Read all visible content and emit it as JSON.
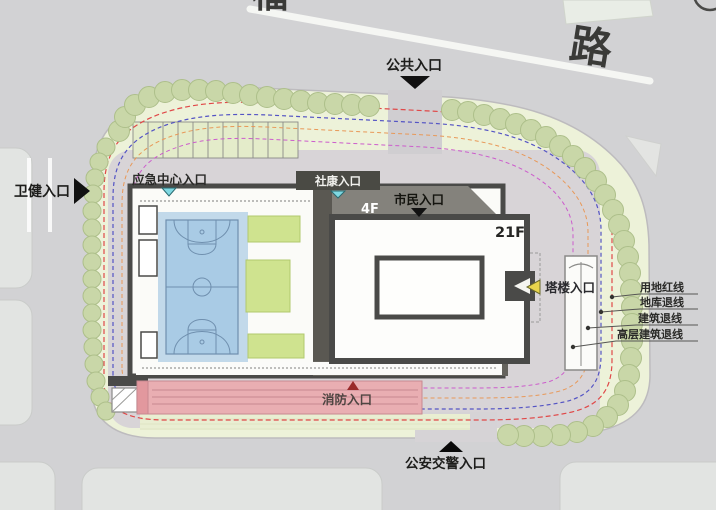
{
  "site_plan": {
    "title": "site-plan",
    "road": {
      "label": "路",
      "partial_label": "福"
    },
    "entrances": {
      "public": {
        "label": "公共入口",
        "arrow": "down",
        "arrow_color": "#111111"
      },
      "health": {
        "label": "卫健入口",
        "arrow": "right",
        "arrow_color": "#111111"
      },
      "emergency": {
        "label": "应急中心入口",
        "arrow": "down",
        "arrow_color": "#7fd8e2"
      },
      "community": {
        "label": "社康入口",
        "arrow": "down",
        "arrow_color": "#7fd8e2"
      },
      "citizen": {
        "label": "市民入口",
        "arrow": "down",
        "arrow_color": "#111111"
      },
      "tower": {
        "label": "塔楼入口",
        "arrow": "left",
        "arrow_color": "#e8d44c"
      },
      "fire": {
        "label": "消防入口",
        "arrow": "up",
        "arrow_color": "#9a2a2a"
      },
      "police": {
        "label": "公安交警入口",
        "arrow": "up",
        "arrow_color": "#0a0a0a"
      }
    },
    "floors": {
      "podium": "4F",
      "tower": "21F"
    },
    "legend": [
      {
        "label": "用地红线",
        "color": "#e04848"
      },
      {
        "label": "地库退线",
        "color": "#5454c4"
      },
      {
        "label": "建筑退线",
        "color": "#e89858"
      },
      {
        "label": "高层建筑退线",
        "color": "#cc5ccc"
      }
    ],
    "colors": {
      "road": "#d2d2d4",
      "lawn": "#edf2d9",
      "plaza": "#d8d4d7",
      "tree": "#c9d7a8",
      "court": "#a9cbe5",
      "grass_patch": "#cfe38f",
      "fire_lane": "#e9aeb2",
      "podium_roof": "#84827c",
      "building_outline": "#4a4a48"
    }
  }
}
